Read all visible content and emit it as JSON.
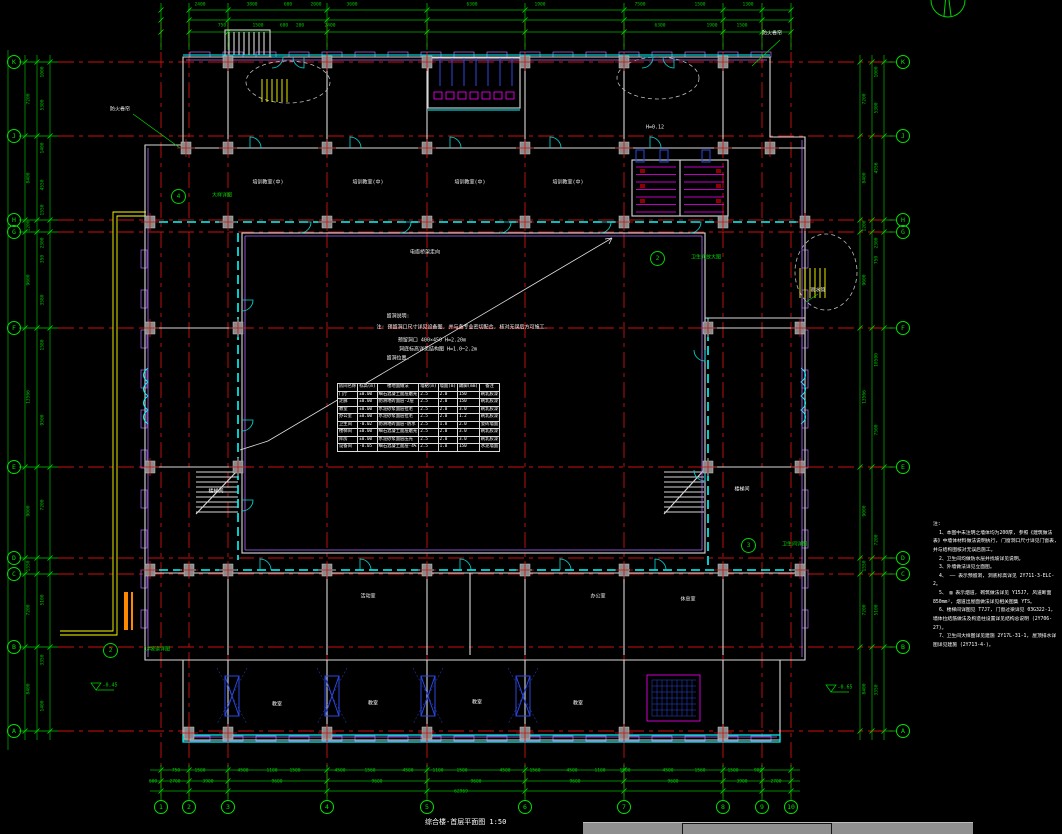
{
  "title": {
    "text": "综合楼-首层平面图 1:50"
  },
  "icons": {
    "north_arrow": "north-arrow",
    "window_fragment": "window-titlebar-fragment"
  },
  "colors": {
    "background": "#000000",
    "grid_red": "#cc1111",
    "dim_green": "#00c800",
    "bubble_green": "#00e000",
    "wall_white": "#d9d9d9",
    "wall_cyan": "#00ffff",
    "magenta": "#ff00ff",
    "violet": "#b06cff",
    "yellow": "#ffff00",
    "orange": "#ff8800",
    "blue": "#2b47e0",
    "column_gray": "#8a8a8a",
    "text_white": "#f2f2f2",
    "taskbar_gray": "#8f8f8f"
  },
  "axes": {
    "rows": [
      {
        "label": "K",
        "y": 62
      },
      {
        "label": "J",
        "y": 136
      },
      {
        "label": "H",
        "y": 220
      },
      {
        "label": "G",
        "y": 232
      },
      {
        "label": "F",
        "y": 328
      },
      {
        "label": "E",
        "y": 467
      },
      {
        "label": "D",
        "y": 558
      },
      {
        "label": "C",
        "y": 574
      },
      {
        "label": "B",
        "y": 647
      },
      {
        "label": "A",
        "y": 731
      }
    ],
    "cols": [
      {
        "label": "1",
        "x": 161
      },
      {
        "label": "2",
        "x": 189
      },
      {
        "label": "3",
        "x": 228
      },
      {
        "label": "4",
        "x": 327
      },
      {
        "label": "5",
        "x": 427
      },
      {
        "label": "6",
        "x": 525
      },
      {
        "label": "7",
        "x": 624
      },
      {
        "label": "8",
        "x": 723
      },
      {
        "label": "9",
        "x": 762
      },
      {
        "label": "10",
        "x": 791
      }
    ]
  },
  "dims": {
    "top_row1": {
      "y": 6,
      "items": [
        {
          "t": "2400",
          "x": 200
        },
        {
          "t": "3800",
          "x": 252
        },
        {
          "t": "600",
          "x": 288
        },
        {
          "t": "2000",
          "x": 316
        },
        {
          "t": "3600",
          "x": 352
        },
        {
          "t": "6300",
          "x": 472
        },
        {
          "t": "1900",
          "x": 540
        },
        {
          "t": "7500",
          "x": 640
        },
        {
          "t": "1500",
          "x": 700
        },
        {
          "t": "1300",
          "x": 748
        }
      ]
    },
    "top_row2": {
      "y": 27,
      "items": [
        {
          "t": "750",
          "x": 222
        },
        {
          "t": "1500",
          "x": 258
        },
        {
          "t": "600",
          "x": 284
        },
        {
          "t": "200",
          "x": 300
        },
        {
          "t": "2400",
          "x": 330
        },
        {
          "t": "6300",
          "x": 660
        },
        {
          "t": "1900",
          "x": 712
        },
        {
          "t": "1500",
          "x": 742
        }
      ]
    },
    "bottom_small": {
      "y": 772,
      "items": [
        {
          "t": "750",
          "x": 176
        },
        {
          "t": "1500",
          "x": 200
        },
        {
          "t": "4500",
          "x": 243
        },
        {
          "t": "1100",
          "x": 272
        },
        {
          "t": "1500",
          "x": 295
        },
        {
          "t": "4500",
          "x": 340
        },
        {
          "t": "1560",
          "x": 370
        },
        {
          "t": "4500",
          "x": 408
        },
        {
          "t": "1100",
          "x": 438
        },
        {
          "t": "1500",
          "x": 462
        },
        {
          "t": "4500",
          "x": 505
        },
        {
          "t": "1560",
          "x": 535
        },
        {
          "t": "4500",
          "x": 572
        },
        {
          "t": "1100",
          "x": 600
        },
        {
          "t": "1500",
          "x": 625
        },
        {
          "t": "4500",
          "x": 668
        },
        {
          "t": "1560",
          "x": 700
        },
        {
          "t": "1500",
          "x": 733
        },
        {
          "t": "900",
          "x": 758
        }
      ]
    },
    "bottom_seg": {
      "y": 783,
      "items": [
        {
          "t": "600",
          "x": 153
        },
        {
          "t": "2700",
          "x": 175
        },
        {
          "t": "3900",
          "x": 208
        },
        {
          "t": "9600",
          "x": 277
        },
        {
          "t": "9600",
          "x": 377
        },
        {
          "t": "9600",
          "x": 476
        },
        {
          "t": "9600",
          "x": 575
        },
        {
          "t": "9600",
          "x": 673
        },
        {
          "t": "3900",
          "x": 742
        },
        {
          "t": "2700",
          "x": 776
        }
      ]
    },
    "bottom_total": {
      "y": 793,
      "items": [
        {
          "t": "62969",
          "x": 461
        }
      ]
    },
    "left_outer": {
      "x": 30,
      "items": [
        {
          "t": "7200",
          "y": 99
        },
        {
          "t": "8400",
          "y": 178
        },
        {
          "t": "1200",
          "y": 226
        },
        {
          "t": "9600",
          "y": 280
        },
        {
          "t": "13566",
          "y": 397
        },
        {
          "t": "9000",
          "y": 511
        },
        {
          "t": "1550",
          "y": 566
        },
        {
          "t": "7200",
          "y": 610
        },
        {
          "t": "8400",
          "y": 689
        }
      ]
    },
    "left_inner": {
      "x": 44,
      "items": [
        {
          "t": "1000",
          "y": 72
        },
        {
          "t": "5300",
          "y": 105
        },
        {
          "t": "1400",
          "y": 148
        },
        {
          "t": "4550",
          "y": 185
        },
        {
          "t": "1550",
          "y": 210
        },
        {
          "t": "2300",
          "y": 243
        },
        {
          "t": "350",
          "y": 259
        },
        {
          "t": "3580",
          "y": 300
        },
        {
          "t": "1580",
          "y": 345
        },
        {
          "t": "9500",
          "y": 420
        },
        {
          "t": "7200",
          "y": 505
        },
        {
          "t": "5100",
          "y": 600
        },
        {
          "t": "3350",
          "y": 660
        },
        {
          "t": "1400",
          "y": 706
        }
      ]
    },
    "right_inner": {
      "x": 866,
      "items": [
        {
          "t": "7200",
          "y": 99
        },
        {
          "t": "8400",
          "y": 178
        },
        {
          "t": "1200",
          "y": 226
        },
        {
          "t": "9600",
          "y": 280
        },
        {
          "t": "13566",
          "y": 397
        },
        {
          "t": "9000",
          "y": 511
        },
        {
          "t": "1550",
          "y": 566
        },
        {
          "t": "7200",
          "y": 610
        },
        {
          "t": "8400",
          "y": 689
        }
      ]
    },
    "right_outer": {
      "x": 878,
      "items": [
        {
          "t": "1000",
          "y": 72
        },
        {
          "t": "5300",
          "y": 108
        },
        {
          "t": "4556",
          "y": 168
        },
        {
          "t": "2300",
          "y": 243
        },
        {
          "t": "750",
          "y": 260
        },
        {
          "t": "10500",
          "y": 360
        },
        {
          "t": "7500",
          "y": 430
        },
        {
          "t": "7200",
          "y": 540
        },
        {
          "t": "5100",
          "y": 610
        },
        {
          "t": "3350",
          "y": 690
        }
      ]
    }
  },
  "labels": [
    {
      "t": "培训教室(中)",
      "x": 268,
      "y": 183,
      "c": "w"
    },
    {
      "t": "培训教室(中)",
      "x": 368,
      "y": 183,
      "c": "w"
    },
    {
      "t": "培训教室(中)",
      "x": 470,
      "y": 183,
      "c": "w"
    },
    {
      "t": "培训教室(中)",
      "x": 568,
      "y": 183,
      "c": "w"
    },
    {
      "t": "活动室",
      "x": 368,
      "y": 597,
      "c": "w"
    },
    {
      "t": "办公室",
      "x": 598,
      "y": 597,
      "c": "w"
    },
    {
      "t": "休息室",
      "x": 688,
      "y": 600,
      "c": "w"
    },
    {
      "t": "教室",
      "x": 277,
      "y": 705,
      "c": "w"
    },
    {
      "t": "教室",
      "x": 373,
      "y": 704,
      "c": "w"
    },
    {
      "t": "教室",
      "x": 477,
      "y": 703,
      "c": "w"
    },
    {
      "t": "教室",
      "x": 578,
      "y": 704,
      "c": "w"
    },
    {
      "t": "楼梯间",
      "x": 216,
      "y": 492,
      "c": "w"
    },
    {
      "t": "楼梯间",
      "x": 742,
      "y": 490,
      "c": "w"
    },
    {
      "t": "防火卷帘",
      "x": 120,
      "y": 110,
      "c": "w"
    },
    {
      "t": "防火卷帘",
      "x": 772,
      "y": 34,
      "c": "w"
    },
    {
      "t": "雨水管",
      "x": 818,
      "y": 291,
      "c": "w"
    },
    {
      "t": "电缆桥架走向",
      "x": 425,
      "y": 253,
      "c": "w"
    },
    {
      "t": "留洞说明:",
      "x": 398,
      "y": 317,
      "c": "w"
    },
    {
      "t": "注: 预留洞口尺寸详见设备图, 并与各专业密切配合, 核对无误后方可施工.",
      "x": 462,
      "y": 328,
      "c": "w"
    },
    {
      "t": "预留洞口 400×450 H=2.20m",
      "x": 432,
      "y": 341,
      "c": "w"
    },
    {
      "t": "洞底标高详见结构图 H=1.0~2.2m",
      "x": 438,
      "y": 350,
      "c": "w"
    },
    {
      "t": "留洞位置.",
      "x": 398,
      "y": 359,
      "c": "w"
    },
    {
      "t": "-0.45",
      "x": 110,
      "y": 686,
      "c": "g"
    },
    {
      "t": "-0.65",
      "x": 845,
      "y": 688,
      "c": "g"
    },
    {
      "t": "H=0.12",
      "x": 655,
      "y": 128,
      "c": "w"
    }
  ],
  "callouts": [
    {
      "x": 178,
      "y": 196,
      "t1": "4",
      "t2": "大样详图"
    },
    {
      "x": 657,
      "y": 258,
      "t1": "2",
      "t2": "卫生间放大图"
    },
    {
      "x": 110,
      "y": 650,
      "t1": "2",
      "t2": "1#坡道详图"
    },
    {
      "x": 748,
      "y": 545,
      "t1": "3",
      "t2": "卫生间详图"
    }
  ],
  "table": {
    "header": [
      "房间名称",
      "标高(m)",
      "楼地面做法",
      "墙裙(m)",
      "墙面(m)",
      "踢脚(mm)",
      "备注"
    ],
    "rows": [
      [
        "门厅",
        "±0.00",
        "细石混凝土面层磨光",
        "2.5",
        "2.0",
        "150",
        "刷乳胶漆"
      ],
      [
        "走廊",
        "±0.00",
        "防滑地砖面层-2层",
        "2.5",
        "2.0",
        "150",
        "刷乳胶漆"
      ],
      [
        "教室",
        "±0.00",
        "水泥砂浆面层拉毛",
        "2.5",
        "2.0",
        "3.0",
        "刷乳胶漆"
      ],
      [
        "办公室",
        "±0.00",
        "水泥砂浆面层拉毛",
        "2.5",
        "2.0",
        "1.2",
        "刷乳胶漆"
      ],
      [
        "卫生间",
        "-0.02",
        "防滑地砖面层-防水",
        "2.5",
        "1.8",
        "2.0",
        "瓷砖墙面"
      ],
      [
        "楼梯间",
        "±0.00",
        "细石混凝土面层磨光",
        "2.5",
        "2.0",
        "3.0",
        "刷乳胶漆"
      ],
      [
        "库房",
        "±0.00",
        "水泥砂浆面层压光",
        "2.5",
        "2.0",
        "3.0",
        "刷乳胶漆"
      ],
      [
        "设备间",
        "-0.05",
        "细石混凝土面层-4%",
        "2.5",
        "1.8",
        "150",
        "水泥墙面"
      ]
    ]
  },
  "notes": {
    "heading": "注:",
    "items": [
      "1、本图中未注明之墙体均为200厚, 参照《建筑做法表》中墙体材料做法说明执行, 门窗洞口尺寸详见门窗表, 并与结构图核对无误后施工。",
      "2、卫生间均做防水层并找坡详见说明。",
      "3、外墙做法详见立面图。",
      "4、 —— 表示预留洞, 洞底标高详见 2Y711-3-ELC-2。",
      "5、 ▨ 表示烟道, 砌筑做法详见 Y15J7, 风道断面 850mm², 烟道出屋面做法详见相关图集 YTS。",
      "6、楼梯间详图见 T7J7, 门窗过梁详见 03G322-1, 墙体拉结筋做法及构造柱设置详见结构总说明 (2Y706-27)。",
      "7、卫生间大样图详见建施 2Y17L-31-1, 屋顶排水详图详见建施 (2Y713-4-)。"
    ]
  }
}
